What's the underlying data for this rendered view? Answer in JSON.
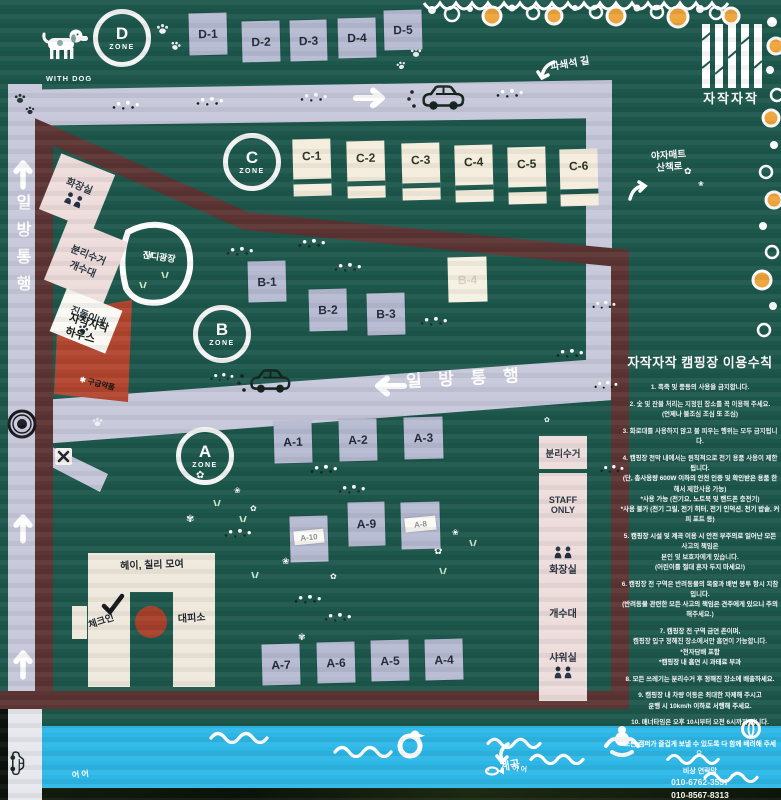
{
  "logo": {
    "name": "자작자작"
  },
  "legend": {
    "with_dog": "WITH DOG"
  },
  "zones": {
    "d": "D",
    "c": "C",
    "b": "B",
    "a": "A",
    "zone_word": "ZONE"
  },
  "sites": {
    "d1": "D-1",
    "d2": "D-2",
    "d3": "D-3",
    "d4": "D-4",
    "d5": "D-5",
    "c1": "C-1",
    "c2": "C-2",
    "c3": "C-3",
    "c4": "C-4",
    "c5": "C-5",
    "c6": "C-6",
    "b1": "B-1",
    "b2": "B-2",
    "b3": "B-3",
    "b4": "B-4",
    "a1": "A-1",
    "a2": "A-2",
    "a3": "A-3",
    "a4": "A-4",
    "a5": "A-5",
    "a6": "A-6",
    "a7": "A-7",
    "a8": "A-8",
    "a9": "A-9",
    "a10": "A-10"
  },
  "roads": {
    "one_way_left": "일방통행",
    "one_way_mid": "일 방 통 행",
    "gravel_path": "파쇄석 길",
    "mat_trail": "야자매트\n산책로"
  },
  "facilities": {
    "toilet_left": "화장실",
    "recycle_sink_left": "분리수거\n개수대",
    "jindol": "진돌이네",
    "house": "자작자작\n하우스",
    "first_aid": "구급약품",
    "lawn": "잔디광장",
    "recycle_right": "분리수거",
    "staff_only": "STAFF\nONLY",
    "toilet_right": "화장실",
    "sink_right": "개수대",
    "shower": "샤워실"
  },
  "building": {
    "title": "헤이, 칠리 모여",
    "checkin": "체크인",
    "shelter": "대피소"
  },
  "water": {
    "valley": "계곡",
    "ducks": "어 어"
  },
  "rules": {
    "title": "자작자작 캠핑장 이용수칙",
    "items": [
      "1. 폭죽 및 풍등의 사용을 금지합니다.",
      "2. 숯 및 잔불 처리는 지정된 장소를 꼭 이용해 주세요.\n(언제나 불조심 조심 또 조심)",
      "3. 화로대를 사용하지 않고 불 피우는 행위는 모두 금지됩니다.",
      "4. 캠핑장 천막 내에서는 원칙적으로 전기 용품 사용이 제한됩니다.\n(단, 총사용량 600W 이하의 안전 인증 및 확인받은 용품 한해서 제한사용 가능)\n*사용 가능 (전기요, 노트북 및 핸드폰 충전기)\n*사용 불가 (전기 그릴, 전기 히터, 전기 인덕션, 전기 밥솥, 커피 포트 등)",
      "5. 캠핑장 시설 및 계곡 이용 시 안전 부주의로 일어난 모든 사고의 책임은\n본인 및 보호자에게 있습니다.\n(어린이를 절대 혼자 두지 마세요!)",
      "6. 캠핑장 전 구역은 반려동물의 목줄과 배변 봉투 항시 지참입니다.\n(반려동물 관련한 모든 사고의 책임은 견주에게 있으니 주의해주세요.)",
      "7. 캠핑장 전 구역 금연 존이며,\n캠핑장 입구 정해진 장소에서만 흡연이 가능합니다.\n*전자담배 포함\n*캠핑장 내 흡연 시 과태료 부과",
      "8. 모든 쓰레기는 분리수거 후 정해진 장소에 배출하세요.",
      "9. 캠핑장 내 차량 이동은 최대한 자제해 주시고\n운행 시 10km/h 이하로 서행해 주세요.",
      "10. 매너타임은 오후 10시부터 오전 6시까지 입니다."
    ],
    "closing": "모든 캠퍼가 즐겁게 보낼 수 있도록 다 함께 배려해 주세요.",
    "contact_label": "비상 연락망",
    "phone1": "010-6762-3557",
    "phone2": "010-8567-8313"
  },
  "colors": {
    "background_green": "#1d574c",
    "road": "#c7c9db",
    "border_brown": "#5c3433",
    "site_lavender": "#b6bbd2",
    "site_cream": "#f5eddd",
    "facility_pink": "#eddcdb",
    "house_red": "#b2452f",
    "water_blue": "#2db7e6",
    "garland_orange": "#eda43b"
  }
}
